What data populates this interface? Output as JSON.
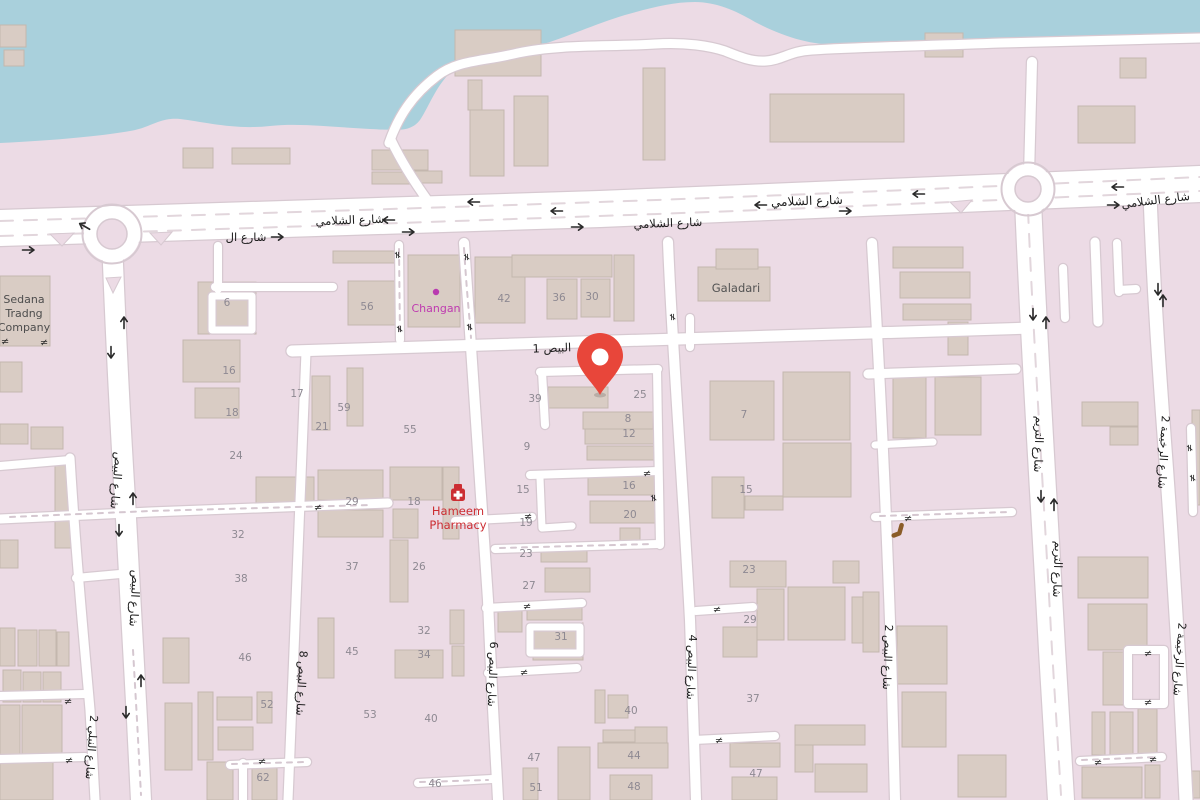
{
  "map": {
    "colors": {
      "water": "#a9d0dc",
      "land": "#ecdbe5",
      "building": "#d9ccc4",
      "building_stroke": "#c4b7ae",
      "road": "#ffffff",
      "road_casing": "#d7c9d1",
      "lane_dash": "#e2d6dc",
      "minor_dash": "#d5c7d0",
      "label": "#1c1c1c",
      "number": "#8e8992",
      "dot_magenta": "#b93ab0",
      "dot_orange": "#d78d37",
      "pin": "#e8463a",
      "arrow": "#2a2a2a",
      "pharmacy_red": "#cc2e33",
      "changan_magenta": "#bf3ab0",
      "poi_gray": "#535353",
      "bench_brown": "#8a5c28"
    },
    "street_labels": [
      {
        "text": "شارع الشلامي",
        "x": 350,
        "y": 224,
        "rot": -2,
        "size": 11.5
      },
      {
        "text": "شارع الشلامي",
        "x": 668,
        "y": 227,
        "rot": -2,
        "size": 11.5
      },
      {
        "text": "شارع الشلامي",
        "x": 807,
        "y": 205,
        "rot": -2,
        "size": 12
      },
      {
        "text": "شارع الشلامي",
        "x": 1156,
        "y": 204,
        "rot": -7,
        "size": 11.5
      },
      {
        "text": "شارع ال",
        "x": 246,
        "y": 241,
        "rot": 0,
        "size": 11.5
      },
      {
        "text": "البيص 1",
        "x": 552,
        "y": 352,
        "rot": -2,
        "size": 11.5
      },
      {
        "text": "شارع البيص",
        "x": 113,
        "y": 480,
        "rot": 95,
        "size": 11.5
      },
      {
        "text": "شارع البيص",
        "x": 131,
        "y": 598,
        "rot": 93,
        "size": 11.5
      },
      {
        "text": "شارع النبلي 2",
        "x": 88,
        "y": 747,
        "rot": 94,
        "size": 11
      },
      {
        "text": "شارع البيص 8",
        "x": 298,
        "y": 683,
        "rot": 93,
        "size": 11
      },
      {
        "text": "شارع البيص 6",
        "x": 489,
        "y": 674,
        "rot": 92,
        "size": 11
      },
      {
        "text": "شارع البيص 4",
        "x": 688,
        "y": 667,
        "rot": 92,
        "size": 11
      },
      {
        "text": "شارع البيص 2",
        "x": 884,
        "y": 657,
        "rot": 92,
        "size": 11
      },
      {
        "text": "شارع التريم",
        "x": 1035,
        "y": 444,
        "rot": 92,
        "size": 11.5
      },
      {
        "text": "شارع التريم",
        "x": 1054,
        "y": 569,
        "rot": 92,
        "size": 11.5
      },
      {
        "text": "شارع الرخيمة 2",
        "x": 1160,
        "y": 452,
        "rot": 93,
        "size": 11
      },
      {
        "text": "شارع الرخيمة 2",
        "x": 1176,
        "y": 659,
        "rot": 94,
        "size": 11
      }
    ],
    "house_numbers": [
      {
        "t": "6",
        "x": 227,
        "y": 306
      },
      {
        "t": "16",
        "x": 229,
        "y": 374
      },
      {
        "t": "18",
        "x": 232,
        "y": 416
      },
      {
        "t": "24",
        "x": 236,
        "y": 459
      },
      {
        "t": "32",
        "x": 238,
        "y": 538
      },
      {
        "t": "38",
        "x": 241,
        "y": 582
      },
      {
        "t": "17",
        "x": 297,
        "y": 397
      },
      {
        "t": "21",
        "x": 322,
        "y": 430
      },
      {
        "t": "59",
        "x": 344,
        "y": 411
      },
      {
        "t": "55",
        "x": 410,
        "y": 433
      },
      {
        "t": "56",
        "x": 367,
        "y": 310
      },
      {
        "t": "42",
        "x": 504,
        "y": 302
      },
      {
        "t": "36",
        "x": 559,
        "y": 301
      },
      {
        "t": "30",
        "x": 592,
        "y": 300
      },
      {
        "t": "39",
        "x": 535,
        "y": 402
      },
      {
        "t": "25",
        "x": 640,
        "y": 398
      },
      {
        "t": "8",
        "x": 628,
        "y": 422
      },
      {
        "t": "12",
        "x": 629,
        "y": 437
      },
      {
        "t": "9",
        "x": 527,
        "y": 450
      },
      {
        "t": "15",
        "x": 523,
        "y": 493
      },
      {
        "t": "19",
        "x": 526,
        "y": 526
      },
      {
        "t": "23",
        "x": 526,
        "y": 557
      },
      {
        "t": "27",
        "x": 529,
        "y": 589
      },
      {
        "t": "16",
        "x": 629,
        "y": 489
      },
      {
        "t": "20",
        "x": 630,
        "y": 518
      },
      {
        "t": "29",
        "x": 352,
        "y": 505
      },
      {
        "t": "18",
        "x": 414,
        "y": 505
      },
      {
        "t": "37",
        "x": 352,
        "y": 570
      },
      {
        "t": "26",
        "x": 419,
        "y": 570
      },
      {
        "t": "7",
        "x": 744,
        "y": 418
      },
      {
        "t": "15",
        "x": 746,
        "y": 493
      },
      {
        "t": "23",
        "x": 749,
        "y": 573
      },
      {
        "t": "29",
        "x": 750,
        "y": 623
      },
      {
        "t": "31",
        "x": 561,
        "y": 640
      },
      {
        "t": "45",
        "x": 352,
        "y": 655
      },
      {
        "t": "32",
        "x": 424,
        "y": 634
      },
      {
        "t": "34",
        "x": 424,
        "y": 658
      },
      {
        "t": "53",
        "x": 370,
        "y": 718
      },
      {
        "t": "40",
        "x": 431,
        "y": 722
      },
      {
        "t": "46",
        "x": 245,
        "y": 661
      },
      {
        "t": "52",
        "x": 267,
        "y": 708
      },
      {
        "t": "62",
        "x": 263,
        "y": 781
      },
      {
        "t": "46",
        "x": 435,
        "y": 787
      },
      {
        "t": "40",
        "x": 631,
        "y": 714
      },
      {
        "t": "44",
        "x": 634,
        "y": 759
      },
      {
        "t": "48",
        "x": 634,
        "y": 790
      },
      {
        "t": "47",
        "x": 534,
        "y": 761
      },
      {
        "t": "51",
        "x": 536,
        "y": 791
      },
      {
        "t": "37",
        "x": 753,
        "y": 702
      },
      {
        "t": "47",
        "x": 756,
        "y": 777
      }
    ],
    "pois": [
      {
        "id": "sedana-trading-company",
        "lines": [
          "Sedana",
          "Tradng",
          "Company"
        ],
        "x": 24,
        "y": 303,
        "color": "#4d4d4d",
        "size": 11
      },
      {
        "id": "changan",
        "lines": [
          "Changan"
        ],
        "x": 436,
        "y": 312,
        "color": "#bf3ab0",
        "size": 11,
        "dot": {
          "x": 436,
          "y": 292
        }
      },
      {
        "id": "galadari",
        "lines": [
          "Galadari"
        ],
        "x": 736,
        "y": 292,
        "color": "#535353",
        "size": 11.5
      },
      {
        "id": "hameem-pharmacy",
        "lines": [
          "Hameem",
          "Pharmacy"
        ],
        "x": 458,
        "y": 515,
        "color": "#cc2e33",
        "size": 11.5,
        "icon": "pharmacy",
        "icon_x": 458,
        "icon_y": 494
      }
    ],
    "dots": [
      {
        "x": 553,
        "y": 402,
        "c": "o"
      },
      {
        "x": 574,
        "y": 401,
        "c": "o"
      },
      {
        "x": 599,
        "y": 402,
        "c": "o"
      },
      {
        "x": 584,
        "y": 401,
        "c": "m"
      },
      {
        "x": 593,
        "y": 401,
        "c": "m"
      },
      {
        "x": 828,
        "y": 393,
        "c": "m"
      },
      {
        "x": 902,
        "y": 402,
        "c": "m"
      },
      {
        "x": 214,
        "y": 384,
        "c": "m"
      },
      {
        "x": 1092,
        "y": 569,
        "c": "m"
      },
      {
        "x": 1143,
        "y": 568,
        "c": "m"
      },
      {
        "x": 273,
        "y": 735,
        "c": "m"
      },
      {
        "x": 702,
        "y": 688,
        "c": "m"
      },
      {
        "x": 529,
        "y": 781,
        "c": "m"
      },
      {
        "x": 1110,
        "y": 766,
        "c": "m"
      },
      {
        "x": 1187,
        "y": 780,
        "c": "m"
      }
    ],
    "bench_icon": {
      "x": 897,
      "y": 530
    },
    "arrows": [
      [
        29,
        250,
        0
      ],
      [
        84,
        226,
        210
      ],
      [
        124,
        322,
        -90
      ],
      [
        111,
        353,
        90
      ],
      [
        473,
        202,
        180
      ],
      [
        556,
        211,
        180
      ],
      [
        760,
        205,
        180
      ],
      [
        918,
        194,
        180
      ],
      [
        1117,
        187,
        180
      ],
      [
        409,
        232,
        0
      ],
      [
        578,
        227,
        0
      ],
      [
        846,
        211,
        0
      ],
      [
        388,
        220,
        180
      ],
      [
        278,
        237,
        0
      ],
      [
        1114,
        205,
        0
      ],
      [
        133,
        498,
        -90
      ],
      [
        119,
        531,
        90
      ],
      [
        141,
        680,
        -90
      ],
      [
        126,
        713,
        90
      ],
      [
        1033,
        315,
        90
      ],
      [
        1046,
        322,
        -90
      ],
      [
        1041,
        497,
        90
      ],
      [
        1054,
        504,
        -90
      ],
      [
        1158,
        290,
        90
      ],
      [
        1163,
        300,
        -90
      ]
    ],
    "gates": [
      [
        398,
        255,
        90
      ],
      [
        467,
        257,
        90
      ],
      [
        400,
        329,
        90
      ],
      [
        470,
        327,
        90
      ],
      [
        673,
        317,
        90
      ],
      [
        647,
        473,
        0
      ],
      [
        654,
        498,
        90
      ],
      [
        528,
        516,
        0
      ],
      [
        318,
        507,
        0
      ],
      [
        68,
        701,
        0
      ],
      [
        69,
        760,
        0
      ],
      [
        262,
        761,
        0
      ],
      [
        527,
        606,
        0
      ],
      [
        524,
        672,
        0
      ],
      [
        717,
        609,
        0
      ],
      [
        719,
        740,
        0
      ],
      [
        908,
        518,
        0
      ],
      [
        1190,
        448,
        90
      ],
      [
        1193,
        478,
        90
      ],
      [
        1148,
        653,
        0
      ],
      [
        1148,
        702,
        0
      ],
      [
        1098,
        762,
        0
      ],
      [
        1153,
        759,
        0
      ],
      [
        5,
        341,
        0
      ],
      [
        44,
        342,
        0
      ]
    ],
    "pin": {
      "x": 600,
      "y": 395
    }
  }
}
